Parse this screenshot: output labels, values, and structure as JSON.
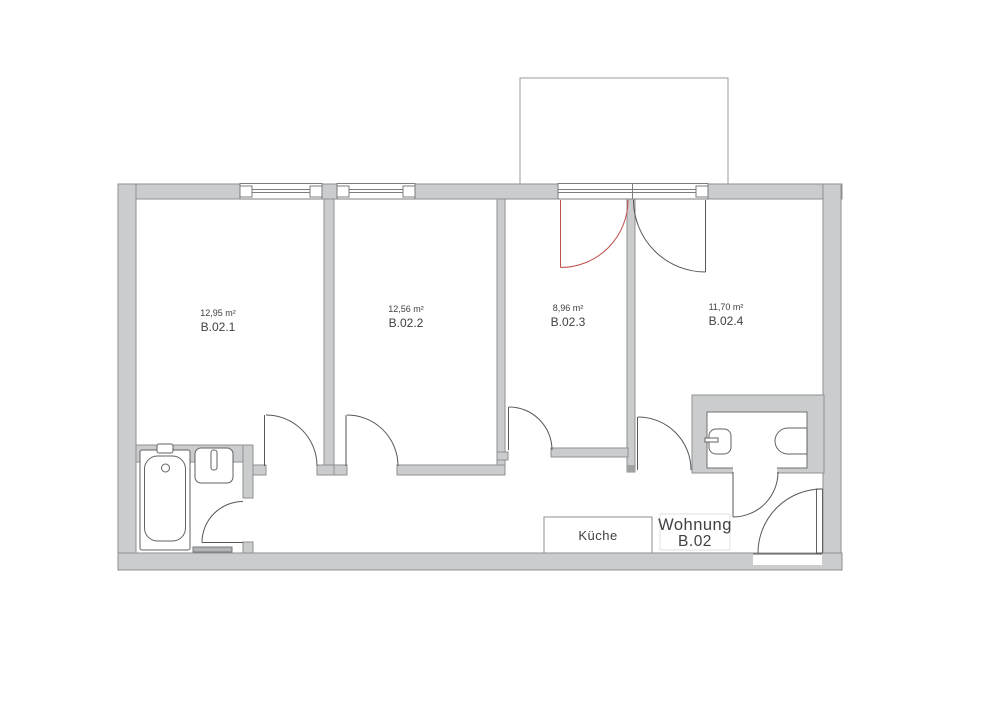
{
  "plan": {
    "apartment_label": {
      "line1": "Wohnung",
      "line2": "B.02"
    },
    "kitchen_label": "Küche",
    "rooms": [
      {
        "name": "B.02.1",
        "area": "12,95 m²"
      },
      {
        "name": "B.02.2",
        "area": "12,56 m²"
      },
      {
        "name": "B.02.3",
        "area": "8,96 m²"
      },
      {
        "name": "B.02.4",
        "area": "11,70 m²"
      }
    ],
    "colors": {
      "wall_fill": "#cbccce",
      "wall_stroke": "#8e9092",
      "line": "#55575a",
      "balcony_door_left": "#c0504d",
      "text": "#3f4144"
    }
  }
}
